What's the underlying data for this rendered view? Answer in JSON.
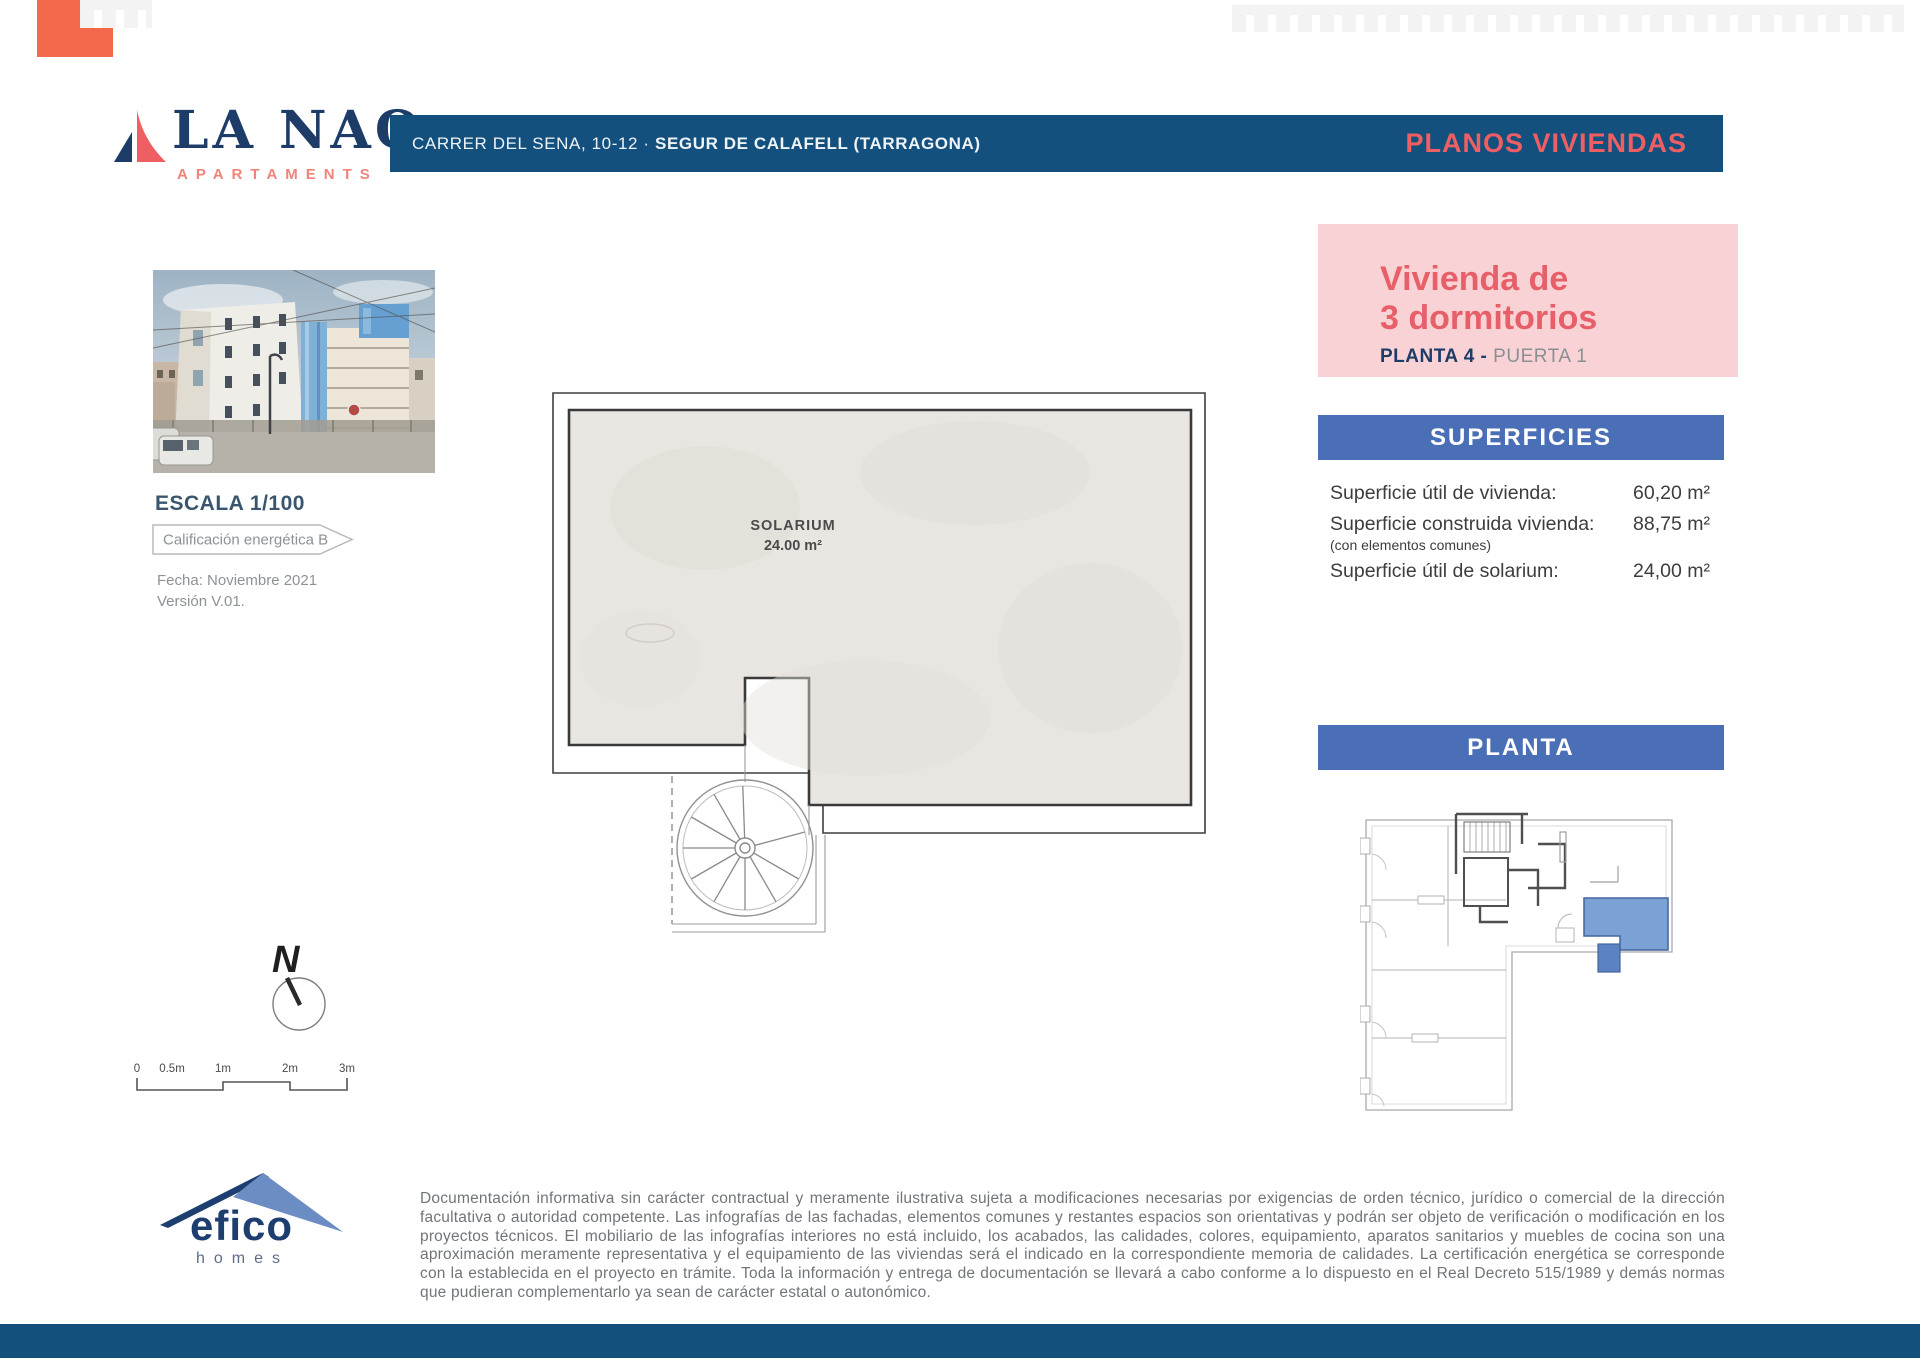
{
  "brand": {
    "name": "LA NAO",
    "subtitle": "APARTAMENTS"
  },
  "header": {
    "address_street": "CARRER DEL SENA, 10-12",
    "address_sep": "·",
    "address_city": "SEGUR DE CALAFELL (TARRAGONA)",
    "right_title": "PLANOS VIVIENDAS"
  },
  "unit_card": {
    "title_line1": "Vivienda de",
    "title_line2": "3 dormitorios",
    "floor": "PLANTA 4 -",
    "door": "PUERTA 1"
  },
  "superficies": {
    "title": "SUPERFICIES",
    "rows": [
      {
        "label": "Superficie útil de vivienda:",
        "note": "",
        "value": "60,20 m²"
      },
      {
        "label": "Superficie construida vivienda:",
        "note": "(con elementos comunes)",
        "value": "88,75 m²"
      },
      {
        "label": "Superficie útil de solarium:",
        "note": "",
        "value": "24,00 m²"
      }
    ]
  },
  "planta": {
    "title": "PLANTA"
  },
  "floorplan": {
    "room": "SOLARIUM",
    "area": "24.00 m²"
  },
  "side_panel": {
    "escala": "ESCALA 1/100",
    "energy": "Calificación energética B",
    "fecha": "Fecha: Noviembre 2021",
    "version": "Versión V.01."
  },
  "compass": {
    "north": "N"
  },
  "scalebar": {
    "ticks": [
      "0",
      "0.5m",
      "1m",
      "2m",
      "3m"
    ]
  },
  "footer": {
    "logo_name": "efico",
    "logo_sub": "homes",
    "legal": "Documentación informativa sin carácter contractual y meramente ilustrativa sujeta a modificaciones necesarias por exigencias de orden técnico, jurídico o comercial de la dirección facultativa o autoridad competente. Las infografías de las fachadas, elementos comunes y restantes espacios son orientativas y podrán ser objeto de verificación o modificación en los proyectos técnicos. El mobiliario de las infografías interiores no está incluido, los acabados, las calidades, colores, equipamiento, aparatos sanitarios y muebles de cocina son una aproximación meramente representativa y el equipamiento de las viviendas será el indicado en la correspondiente memoria de calidades. La certificación energética se corresponde con la establecida en el proyecto en trámite. Toda la información y entrega de documentación se llevará a cabo conforme a lo dispuesto en el Real Decreto 515/1989 y demás normas que pudieran complementarlo ya sean de carácter estatal o autonómico."
  },
  "colors": {
    "navy": "#13507d",
    "coral": "#ee5f63",
    "pink_bg": "#f9d2d6",
    "pink_text": "#e75f68",
    "bar_blue": "#4a6fb7",
    "footer_navy": "#14507c",
    "unit_blue": "#7ba2d4",
    "floor_gray": "#e9e6e2"
  }
}
